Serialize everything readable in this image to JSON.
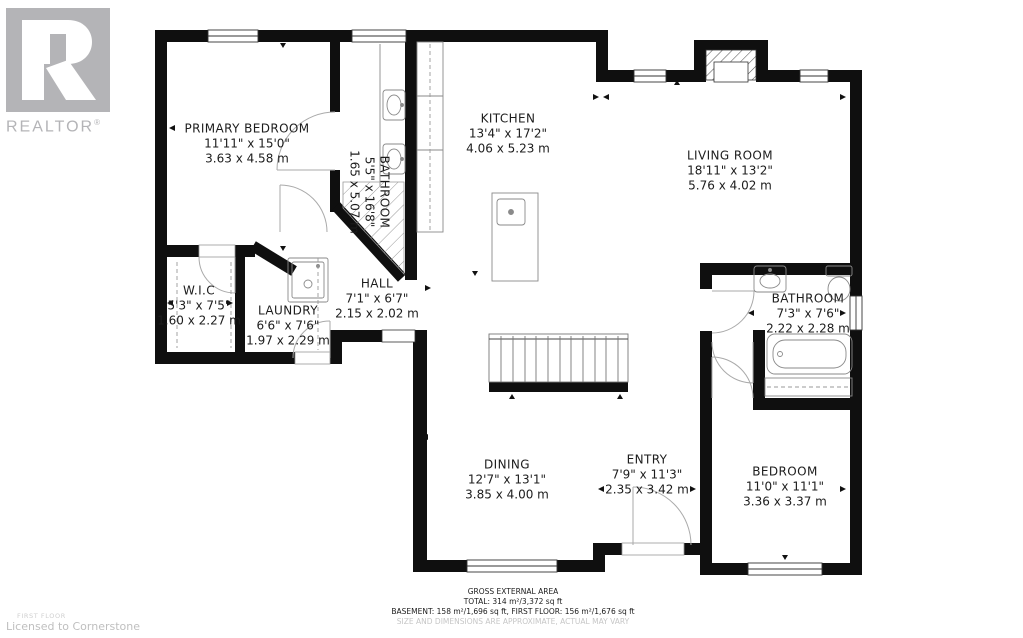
{
  "branding": {
    "logo_text": "REALTOR",
    "registered_mark": "®"
  },
  "watermark": {
    "floor_label": "FIRST FLOOR",
    "license_text": "Licensed to Cornerstone"
  },
  "rooms": [
    {
      "name": "PRIMARY BEDROOM",
      "imperial": "11'11\" x 15'0\"",
      "metric": "3.63 x 4.58 m"
    },
    {
      "name": "BATHROOM",
      "imperial": "5'5\" x 16'8\"",
      "metric": "1.65 x 5.07 m"
    },
    {
      "name": "KITCHEN",
      "imperial": "13'4\" x 17'2\"",
      "metric": "4.06 x 5.23 m"
    },
    {
      "name": "LIVING ROOM",
      "imperial": "18'11\" x 13'2\"",
      "metric": "5.76 x 4.02 m"
    },
    {
      "name": "W.I.C",
      "imperial": "5'3\" x 7'5\"",
      "metric": "1.60 x 2.27 m"
    },
    {
      "name": "LAUNDRY",
      "imperial": "6'6\" x 7'6\"",
      "metric": "1.97 x 2.29 m"
    },
    {
      "name": "HALL",
      "imperial": "7'1\" x 6'7\"",
      "metric": "2.15 x 2.02 m"
    },
    {
      "name": "BATHROOM",
      "imperial": "7'3\" x 7'6\"",
      "metric": "2.22 x 2.28 m"
    },
    {
      "name": "DINING",
      "imperial": "12'7\" x 13'1\"",
      "metric": "3.85 x 4.00 m"
    },
    {
      "name": "ENTRY",
      "imperial": "7'9\" x 11'3\"",
      "metric": "2.35 x 3.42 m"
    },
    {
      "name": "BEDROOM",
      "imperial": "11'0\" x 11'1\"",
      "metric": "3.36 x 3.37 m"
    }
  ],
  "area_summary": {
    "title": "GROSS EXTERNAL AREA",
    "total": "TOTAL: 314 m²/3,372 sq ft",
    "breakdown": "BASEMENT: 158 m²/1,696 sq ft, FIRST FLOOR: 156 m²/1,676 sq ft",
    "disclaimer": "SIZE AND DIMENSIONS ARE APPROXIMATE, ACTUAL MAY VARY"
  },
  "icons": [
    "fireplace-icon",
    "stairs-icon",
    "kitchen-island-icon",
    "sink-icon",
    "toilet-icon",
    "bathtub-icon",
    "shower-icon",
    "washer-icon",
    "door-arc",
    "window",
    "dimension-arrow"
  ],
  "colors": {
    "wall": "#0f0f0f",
    "fixture_stroke": "#8a8a8a",
    "door_arc": "#aaaaaa",
    "logo_gray": "#b4b4b7",
    "footer_gray": "#c6c6c6",
    "text": "#1c1c1c"
  }
}
